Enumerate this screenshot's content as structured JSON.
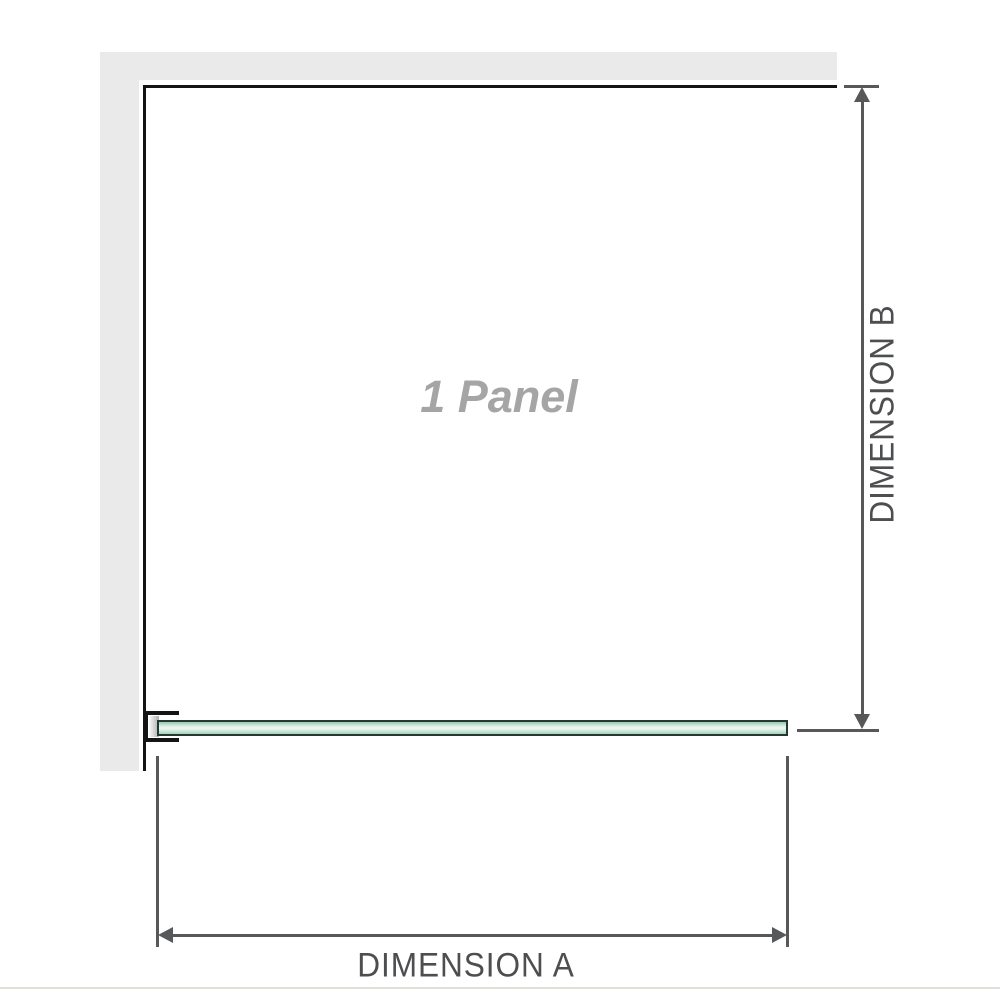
{
  "diagram": {
    "panel_label": "1 Panel",
    "dimensions": {
      "a_label": "DIMENSION A",
      "b_label": "DIMENSION B"
    },
    "colors": {
      "wall": "#eaeaea",
      "outline": "#141414",
      "dimension_line": "#57585a",
      "dimension_text": "#4d4e50",
      "panel_text": "#a5a5a5",
      "glass_border": "#233931",
      "glass_green_top": "#93c9ab",
      "glass_green_light": "#e9f5ee",
      "glass_green_bottom": "#a3d2b8",
      "bracket_fill": "#ffffff",
      "mount_block_gray": "#adadad",
      "baseline": "#e2dfda"
    }
  }
}
